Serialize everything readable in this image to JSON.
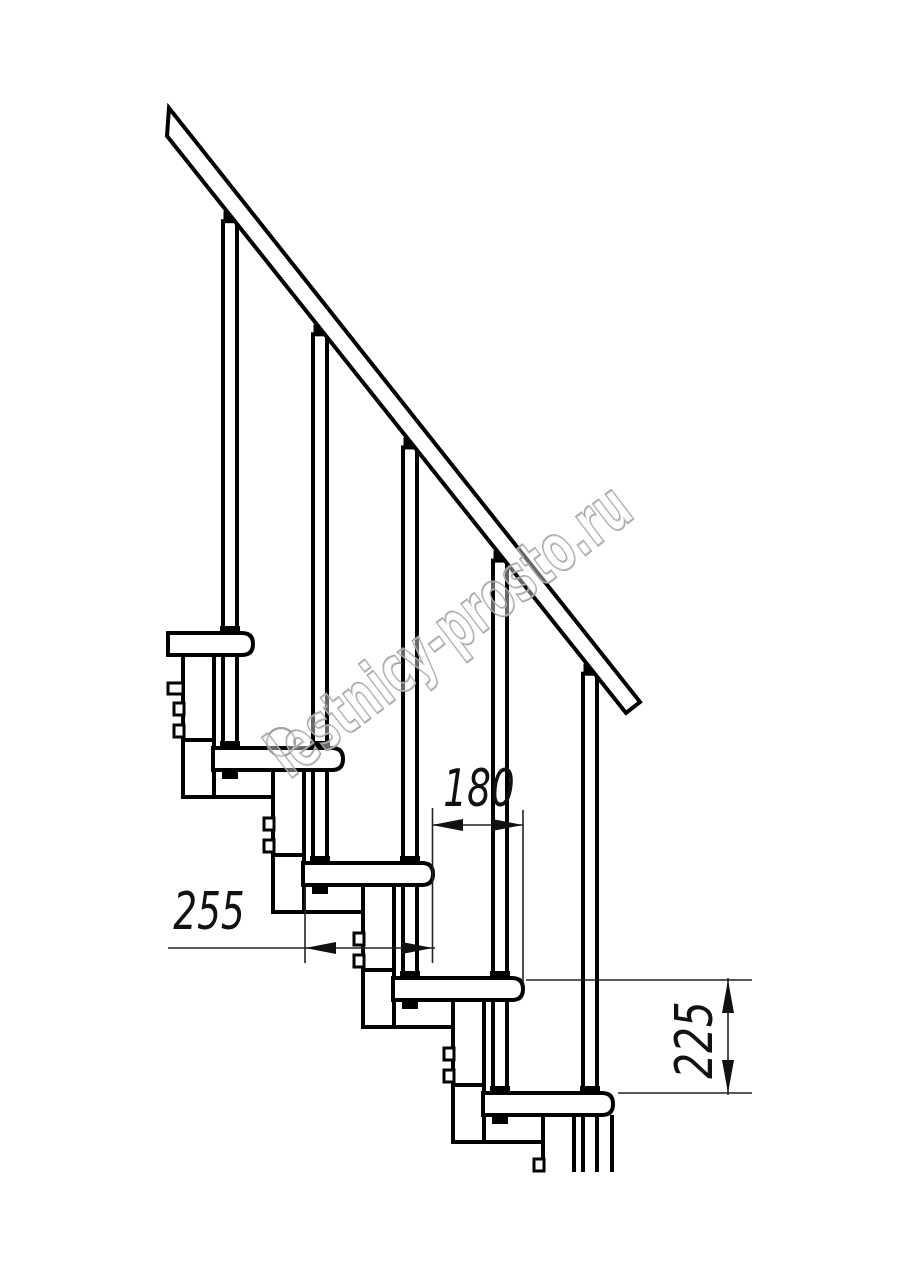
{
  "drawing": {
    "background": "#ffffff",
    "line_color": "#000000",
    "thin_line_color": "#222222",
    "dimensions": [
      {
        "id": "tread-depth-mm",
        "value": "255"
      },
      {
        "id": "step-run-mm",
        "value": "180"
      },
      {
        "id": "step-rise-mm",
        "value": "225"
      }
    ],
    "watermark": {
      "text": "lestnicy-prosto.ru",
      "color": "#969696"
    }
  }
}
